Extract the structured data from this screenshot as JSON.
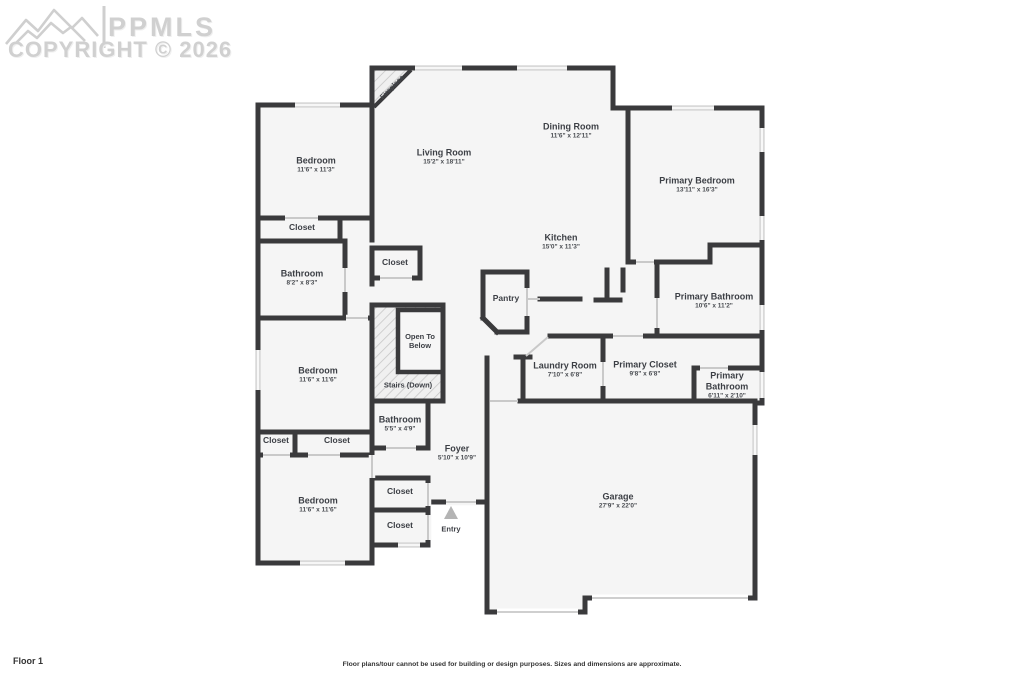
{
  "watermark": {
    "brand": "PPMLS",
    "copyright": "COPYRIGHT © 2026"
  },
  "footer": {
    "floor_label": "Floor 1",
    "disclaimer": "Floor plans/tour cannot be used for building or design purposes. Sizes and dimensions are approximate."
  },
  "colors": {
    "wall": "#3a3a3c",
    "room_fill": "#f5f5f5",
    "window": "#d9d9d9",
    "door": "#c9c9c9",
    "hatch_line": "#c7c7c7",
    "watermark": "#d0d0d0",
    "entry_arrow": "#b4b4b4"
  },
  "rooms": {
    "bedroom_top": {
      "name": "Bedroom",
      "dims": "11'6\" x 11'3\""
    },
    "living": {
      "name": "Living Room",
      "dims": "15'2\" x 18'11\""
    },
    "dining": {
      "name": "Dining Room",
      "dims": "11'6\" x 12'11\""
    },
    "primary_bedroom": {
      "name": "Primary Bedroom",
      "dims": "13'11\" x 16'3\""
    },
    "closet_a": {
      "name": "Closet"
    },
    "bathroom_top": {
      "name": "Bathroom",
      "dims": "8'2\" x 8'3\""
    },
    "closet_b": {
      "name": "Closet"
    },
    "kitchen": {
      "name": "Kitchen",
      "dims": "15'0\" x 11'3\""
    },
    "pantry": {
      "name": "Pantry"
    },
    "primary_bathroom": {
      "name": "Primary Bathroom",
      "dims": "10'6\" x 11'2\""
    },
    "open_below": {
      "name": "Open To Below"
    },
    "stairs": {
      "name": "Stairs (Down)"
    },
    "laundry": {
      "name": "Laundry Room",
      "dims": "7'10\" x 6'8\""
    },
    "primary_closet": {
      "name": "Primary Closet",
      "dims": "9'8\" x 6'8\""
    },
    "primary_bathroom_2": {
      "name": "Primary Bathroom",
      "dims": "6'11\" x 2'10\""
    },
    "bedroom_mid": {
      "name": "Bedroom",
      "dims": "11'6\" x 11'6\""
    },
    "closet_c": {
      "name": "Closet"
    },
    "closet_d": {
      "name": "Closet"
    },
    "bathroom_2": {
      "name": "Bathroom",
      "dims": "5'5\" x 4'9\""
    },
    "foyer": {
      "name": "Foyer",
      "dims": "5'10\" x 10'9\""
    },
    "closet_e": {
      "name": "Closet"
    },
    "closet_f": {
      "name": "Closet"
    },
    "bedroom_bottom": {
      "name": "Bedroom",
      "dims": "11'6\" x 11'6\""
    },
    "entry": {
      "name": "Entry"
    },
    "garage": {
      "name": "Garage",
      "dims": "27'9\" x 22'0\""
    },
    "fireplace": {
      "name": "Fireplace"
    }
  }
}
